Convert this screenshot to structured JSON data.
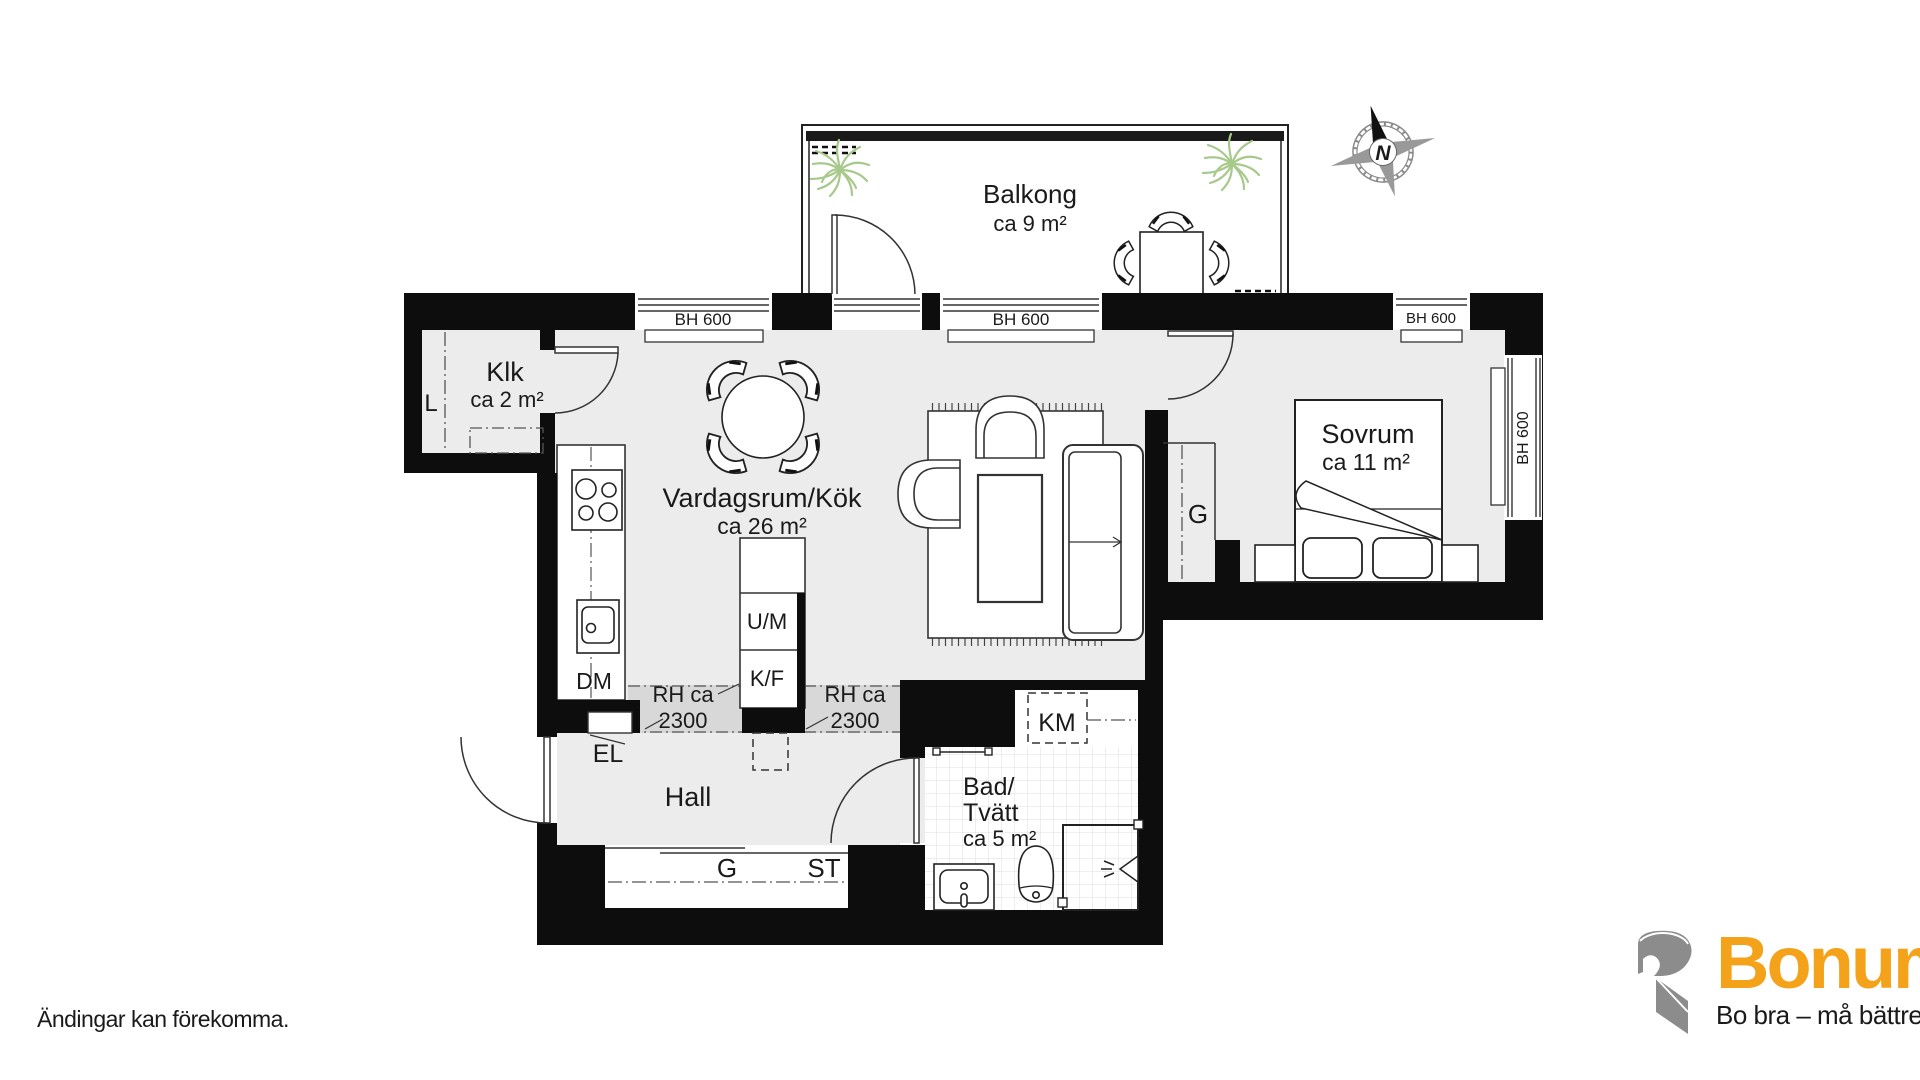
{
  "page": {
    "background": "#FFFFFF",
    "disclaimer": "Ändingar kan förekomma."
  },
  "brand": {
    "name": "Bonum",
    "tagline": "Bo bra – må bättre",
    "orange": "#F5A21B",
    "gray": "#8C8C8C"
  },
  "compass": {
    "north_label": "N"
  },
  "rooms": {
    "balcony": {
      "name": "Balkong",
      "area": "ca 9 m²"
    },
    "klk": {
      "name": "Klk",
      "area": "ca 2 m²"
    },
    "living_kitchen": {
      "name": "Vardagsrum/Kök",
      "area": "ca 26 m²"
    },
    "bedroom": {
      "name": "Sovrum",
      "area": "ca 11 m²"
    },
    "hall": {
      "name": "Hall"
    },
    "bath": {
      "name_line1": "Bad/",
      "name_line2": "Tvätt",
      "area": "ca 5 m²"
    }
  },
  "labels": {
    "window_height": "BH 600",
    "rh_line1": "RH ca",
    "rh_line2": "2300",
    "oven_microwave": "U/M",
    "fridge_freezer": "K/F",
    "dishwasher": "DM",
    "electrical_cabinet": "EL",
    "washing_machine": "KM",
    "wardrobe": "G",
    "cleaning_closet": "ST",
    "linen_closet": "L"
  },
  "colors": {
    "wall": "#0D0D0D",
    "floor": "#ECECEC",
    "reduced_height_zone": "#D8D8D8",
    "tile_line": "#DCDCDC",
    "plant": "#A7C98B"
  }
}
